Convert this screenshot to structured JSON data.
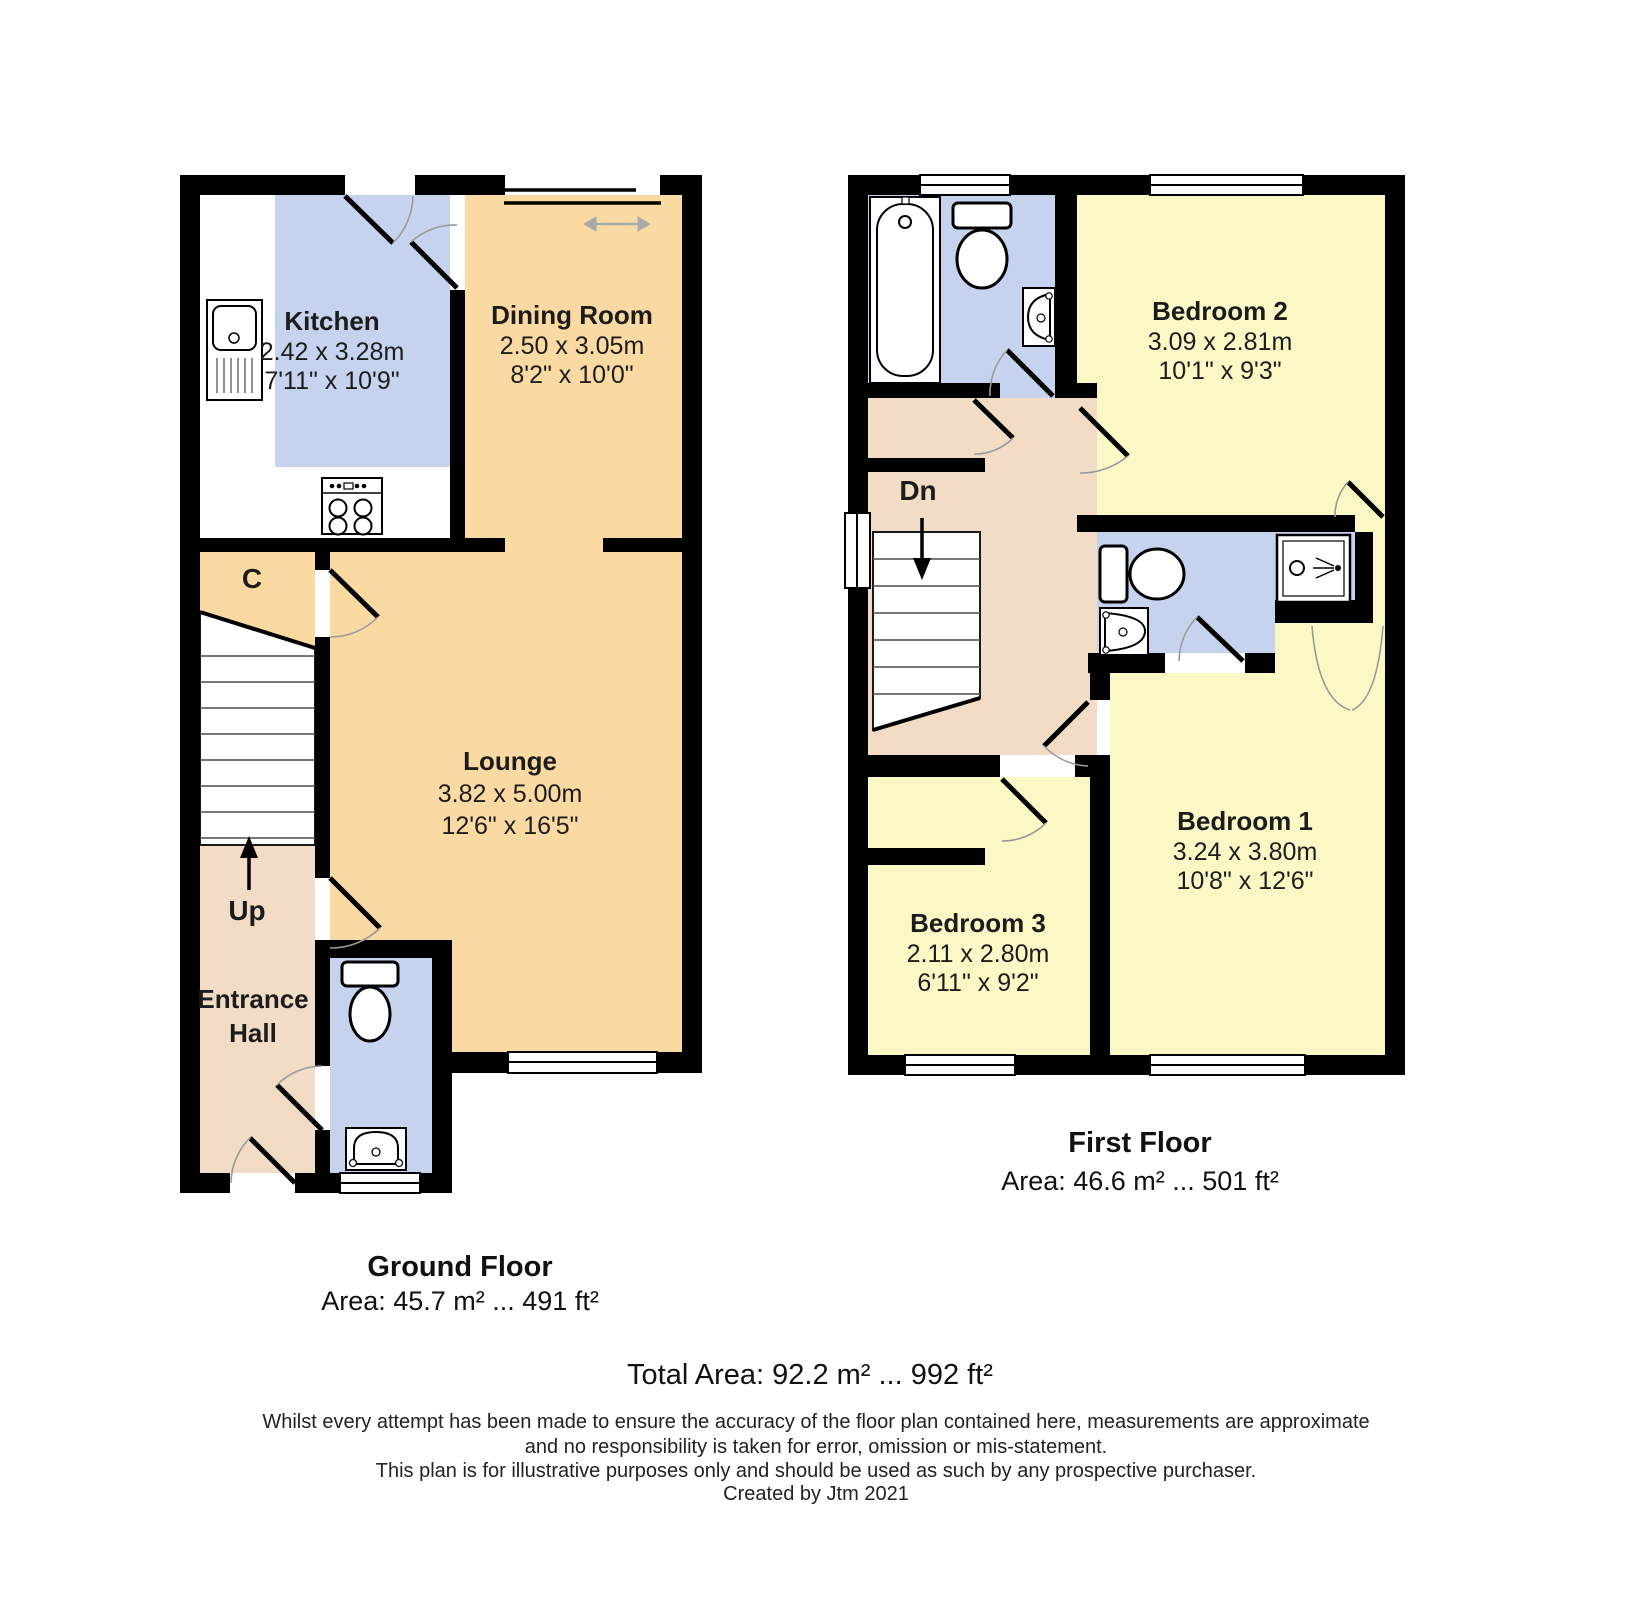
{
  "ground_floor": {
    "kitchen": {
      "name": "Kitchen",
      "dim_m": "2.42 x 3.28m",
      "dim_ft": "7'11\" x 10'9\""
    },
    "dining_room": {
      "name": "Dining Room",
      "dim_m": "2.50 x 3.05m",
      "dim_ft": "8'2\" x 10'0\""
    },
    "lounge": {
      "name": "Lounge",
      "dim_m": "3.82 x 5.00m",
      "dim_ft": "12'6\" x 16'5\""
    },
    "cupboard_label": "C",
    "stairs_label": "Up",
    "hall_line1": "Entrance",
    "hall_line2": "Hall",
    "caption_title": "Ground Floor",
    "caption_area": "Area: 45.7 m² ... 491 ft²"
  },
  "first_floor": {
    "bedroom1": {
      "name": "Bedroom 1",
      "dim_m": "3.24 x 3.80m",
      "dim_ft": "10'8\" x 12'6\""
    },
    "bedroom2": {
      "name": "Bedroom 2",
      "dim_m": "3.09 x 2.81m",
      "dim_ft": "10'1\" x 9'3\""
    },
    "bedroom3": {
      "name": "Bedroom 3",
      "dim_m": "2.11 x 2.80m",
      "dim_ft": "6'11\" x 9'2\""
    },
    "stairs_label": "Dn",
    "caption_title": "First Floor",
    "caption_area": "Area: 46.6 m² ... 501 ft²"
  },
  "summary": {
    "total_area": "Total Area: 92.2 m² ... 992 ft²"
  },
  "disclaimer": {
    "line1": "Whilst every attempt has been made to ensure the accuracy of the floor plan contained here, measurements are approximate",
    "line2": "and no responsibility is taken for error, omission or mis-statement.",
    "line3": "This plan is for illustrative purposes only and should be used as such by any prospective purchaser.",
    "credit": "Created by Jtm 2021"
  },
  "colors": {
    "wall": "#000000",
    "wet_room_blue": "#c5d3ee",
    "living_orange": "#fbd9a2",
    "hall_pink": "#f2dcc6",
    "bedroom_yellow": "#fbf8c5",
    "door_arc_gray": "#9a9a9a"
  }
}
